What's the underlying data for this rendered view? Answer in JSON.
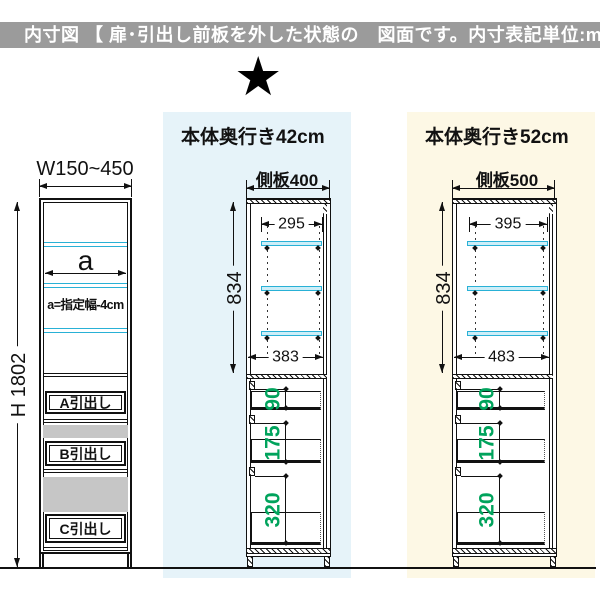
{
  "header": {
    "label": "内寸図 【 扉･引出し前板を外した状態の　図面です。内寸表記単位:mm 】"
  },
  "star_icon": "★",
  "panel_42": {
    "title": "本体奥行き42cm"
  },
  "panel_52": {
    "title": "本体奥行き52cm"
  },
  "left_cabinet": {
    "width_label": "W150~450",
    "height_label": "H 1802",
    "shelf_width_label": "a",
    "shelf_width_note": "a=指定幅-4cm",
    "drawers": [
      "A引出し",
      "B引出し",
      "C引出し"
    ]
  },
  "cabinet_42": {
    "side_panel_label": "側板400",
    "top_inner_width_mm": "295",
    "inner_height_mm": "834",
    "bottom_inner_width_mm": "383",
    "drawer_inner_heights_mm": [
      "90",
      "175",
      "320"
    ]
  },
  "cabinet_52": {
    "side_panel_label": "側板500",
    "top_inner_width_mm": "395",
    "inner_height_mm": "834",
    "bottom_inner_width_mm": "483",
    "drawer_inner_heights_mm": [
      "90",
      "175",
      "320"
    ]
  },
  "colors": {
    "header_bg": "#9b9b9b",
    "panel_42_bg": "#e6f3f9",
    "panel_52_bg": "#fdf8e5",
    "shelf_cyan": "#29b1d6",
    "dimension_green": "#00a35c",
    "drawer_gap_gray": "#c6c6c6"
  }
}
